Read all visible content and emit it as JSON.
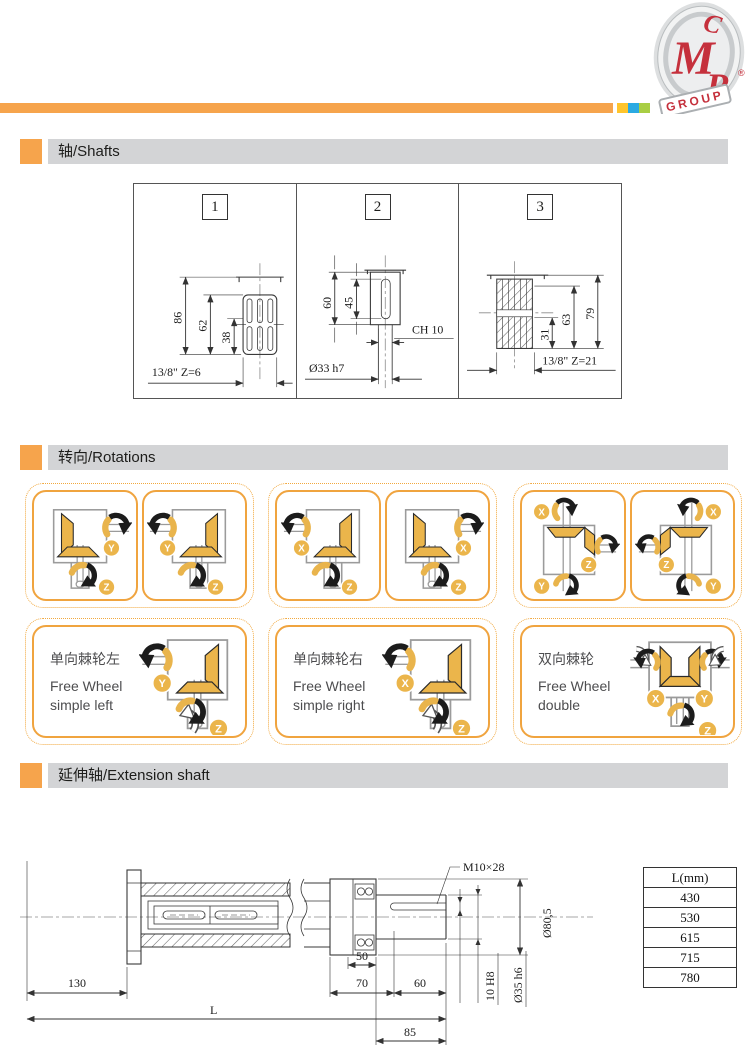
{
  "colors": {
    "accent_orange": "#F6A44C",
    "square_yellow": "#FFC52C",
    "square_blue": "#2BAAE2",
    "square_green": "#A9CE44",
    "gear_gold": "#EBB54B",
    "header_gray": "#D3D4D6",
    "logo_red": "#C5303C"
  },
  "logo": {
    "c": "C",
    "m": "M",
    "r": "R",
    "group": "GROUP",
    "registered": "®"
  },
  "shafts": {
    "title": "轴/Shafts",
    "panels": [
      {
        "number": "1",
        "dims": [
          "86",
          "62",
          "38"
        ],
        "bottom_label": "13/8\" Z=6"
      },
      {
        "number": "2",
        "dims": [
          "60",
          "45"
        ],
        "side_label": "CH 10",
        "bottom_label": "Ø33 h7"
      },
      {
        "number": "3",
        "dims": [
          "79",
          "63",
          "31"
        ],
        "bottom_label": "13/8\" Z=21"
      }
    ]
  },
  "rotations": {
    "title": "转向/Rotations",
    "row1": [
      {
        "cards": [
          {
            "variant": "sideR",
            "axes": [
              "Y",
              "Z"
            ]
          },
          {
            "variant": "sideL",
            "axes": [
              "Y",
              "Z"
            ]
          }
        ]
      },
      {
        "cards": [
          {
            "variant": "sideL",
            "axes": [
              "X",
              "Z"
            ]
          },
          {
            "variant": "sideR",
            "axes": [
              "X",
              "Z"
            ]
          }
        ]
      },
      {
        "cards": [
          {
            "variant": "three",
            "axes": [
              "X",
              "Z",
              "Y"
            ]
          },
          {
            "variant": "threeM",
            "axes": [
              "X",
              "Z",
              "Y"
            ]
          }
        ]
      }
    ],
    "row2": [
      {
        "variant": "fw",
        "axes": [
          "Y",
          "Z"
        ],
        "title_zh": "单向棘轮左",
        "title_en1": "Free Wheel",
        "title_en2": "simple left"
      },
      {
        "variant": "fw",
        "axes": [
          "X",
          "Z"
        ],
        "title_zh": "单向棘轮右",
        "title_en1": "Free Wheel",
        "title_en2": "simple right"
      },
      {
        "variant": "dbl",
        "axes": [
          "X",
          "Y",
          "Z"
        ],
        "title_zh": "双向棘轮",
        "title_en1": "Free Wheel",
        "title_en2": "double"
      }
    ]
  },
  "extension": {
    "title": "延伸轴/Extension shaft",
    "labels": {
      "thread": "M10×28",
      "outer_dia": "Ø80,5",
      "len50": "50",
      "len70": "70",
      "len60": "60",
      "len130": "130",
      "lenL": "L",
      "len85": "85",
      "key": "10 H8",
      "shaft_dia": "Ø35 h6"
    },
    "table": {
      "header": "L(mm)",
      "rows": [
        "430",
        "530",
        "615",
        "715",
        "780"
      ]
    }
  }
}
